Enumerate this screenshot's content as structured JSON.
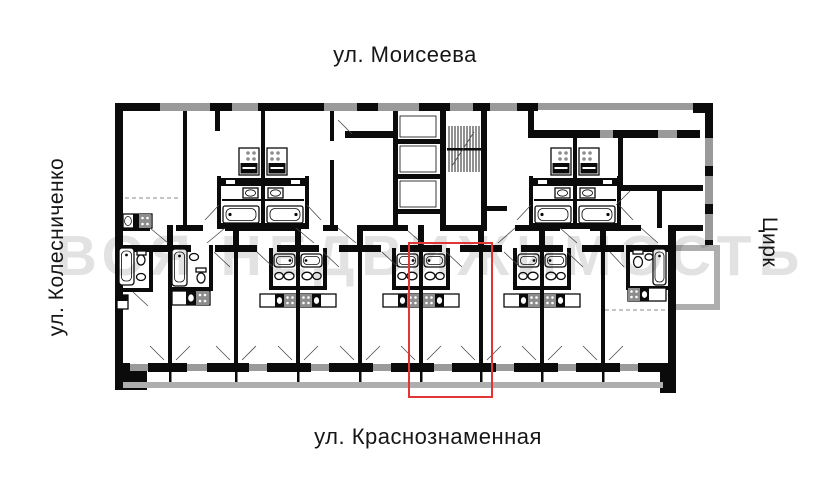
{
  "labels": {
    "top_street": "ул. Моисеева",
    "bottom_street": "ул. Краснознаменная",
    "left_street": "ул. Колесниченко",
    "right_landmark": "Цирк"
  },
  "watermark": {
    "text": "ВСЯ НЕДВИЖИМОСТЬ",
    "color": "#e2e2e2"
  },
  "highlight": {
    "color": "#e23636"
  },
  "plan": {
    "wall_color": "#0b0b0b",
    "window_color": "#9a9a9a",
    "balcony_color": "#aeaeae"
  }
}
